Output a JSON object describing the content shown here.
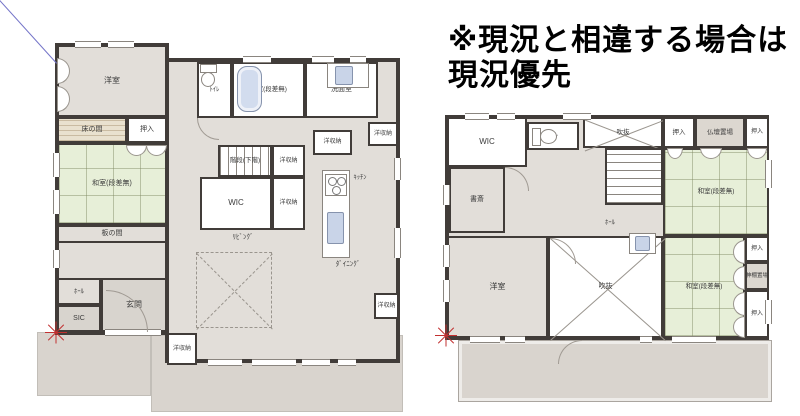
{
  "notice": {
    "line1": "※現況と相違する場合は",
    "line2": "現況優先"
  },
  "colors": {
    "wall": "#413c39",
    "floor": "#e2ded9",
    "tatami": "#e7efd8",
    "white": "#ffffff",
    "wood": "#e9e1cf",
    "ground": "#d9d4ce",
    "genkan": "#d8d4ce",
    "altar": "#dcd7d0",
    "fixture_blue": "#c9d4e8",
    "red_mark": "#c23030",
    "blue_line": "#7474c8"
  },
  "blue_line": {
    "x1": 0,
    "y1": 0,
    "x2": 57,
    "y2": 63
  },
  "floors": {
    "floor1": {
      "name": "first-floor-plan",
      "rooms": [
        {
          "id": "ground-left",
          "x": 37,
          "y": 332,
          "w": 114,
          "h": 64,
          "t": "ground"
        },
        {
          "id": "ground-main",
          "x": 151,
          "y": 335,
          "w": 252,
          "h": 77,
          "t": "ground"
        },
        {
          "id": "outline-west-wing",
          "x": 55,
          "y": 43,
          "w": 114,
          "h": 292,
          "t": "outline"
        },
        {
          "id": "outline-main",
          "x": 165,
          "y": 58,
          "w": 235,
          "h": 305,
          "t": "outline"
        },
        {
          "id": "room-yoshitsu-1f",
          "label": "洋室",
          "x": 57,
          "y": 45,
          "w": 110,
          "h": 72,
          "t": "floor",
          "fs": 8
        },
        {
          "id": "room-tokonoma",
          "label": "床の間",
          "x": 57,
          "y": 117,
          "w": 70,
          "h": 26,
          "t": "wood",
          "fs": 7
        },
        {
          "id": "room-oshiire-1f",
          "label": "押入",
          "x": 127,
          "y": 117,
          "w": 40,
          "h": 26,
          "t": "white",
          "fs": 7
        },
        {
          "id": "room-washitsu-1f",
          "label": "和室(段差無)",
          "x": 57,
          "y": 143,
          "w": 110,
          "h": 82,
          "t": "tatami",
          "fs": 7
        },
        {
          "id": "room-itanoma",
          "label": "板の間",
          "x": 57,
          "y": 225,
          "w": 110,
          "h": 18,
          "t": "floor",
          "fs": 7
        },
        {
          "id": "room-hall-1f",
          "label": "ﾎｰﾙ",
          "x": 57,
          "y": 278,
          "w": 44,
          "h": 27,
          "t": "floor",
          "fs": 6.5
        },
        {
          "id": "room-sic",
          "label": "SIC",
          "x": 57,
          "y": 305,
          "w": 44,
          "h": 27,
          "t": "genkan",
          "fs": 7
        },
        {
          "id": "room-genkan",
          "label": "玄関",
          "x": 101,
          "y": 278,
          "w": 66,
          "h": 54,
          "t": "genkan",
          "fs": 8
        },
        {
          "id": "room-yoshuno-entrance",
          "label": "洋収納",
          "x": 167,
          "y": 333,
          "w": 30,
          "h": 32,
          "t": "white",
          "fs": 6
        },
        {
          "id": "room-toilet-1f",
          "label": "ﾄｲﾚ",
          "x": 197,
          "y": 62,
          "w": 35,
          "h": 56,
          "t": "white",
          "fs": 6.5
        },
        {
          "id": "room-bath",
          "label": "浴室(段差無)",
          "x": 232,
          "y": 62,
          "w": 73,
          "h": 56,
          "t": "white",
          "fs": 6.5
        },
        {
          "id": "room-senmen",
          "label": "洗面室",
          "x": 305,
          "y": 62,
          "w": 73,
          "h": 56,
          "t": "white",
          "fs": 7
        },
        {
          "id": "room-stairs-1f",
          "label": "階段(下階)",
          "x": 218,
          "y": 145,
          "w": 54,
          "h": 32,
          "t": "stairs-v",
          "fs": 6.5
        },
        {
          "id": "room-wic-1f",
          "label": "WIC",
          "x": 200,
          "y": 177,
          "w": 72,
          "h": 53,
          "t": "white",
          "fs": 8
        },
        {
          "id": "room-yoshuno-a",
          "label": "洋収納",
          "x": 272,
          "y": 145,
          "w": 33,
          "h": 32,
          "t": "white",
          "fs": 6
        },
        {
          "id": "room-yoshuno-b",
          "label": "洋収納",
          "x": 272,
          "y": 177,
          "w": 33,
          "h": 53,
          "t": "white",
          "fs": 6
        },
        {
          "id": "room-yoshuno-c",
          "label": "洋収納",
          "x": 313,
          "y": 130,
          "w": 39,
          "h": 25,
          "t": "white",
          "fs": 6
        },
        {
          "id": "room-yoshuno-d",
          "label": "洋収納",
          "x": 368,
          "y": 122,
          "w": 30,
          "h": 24,
          "t": "white",
          "fs": 6
        },
        {
          "id": "room-yoshuno-e",
          "label": "洋収納",
          "x": 374,
          "y": 293,
          "w": 25,
          "h": 26,
          "t": "white",
          "fs": 6
        },
        {
          "id": "label-living",
          "label": "ﾘﾋﾞﾝｸﾞ",
          "x": 213,
          "y": 232,
          "w": 60,
          "h": 12,
          "t": "label",
          "fs": 7
        },
        {
          "id": "label-dining",
          "label": "ﾀﾞｲﾆﾝｸﾞ",
          "x": 318,
          "y": 259,
          "w": 60,
          "h": 12,
          "t": "label",
          "fs": 7
        },
        {
          "id": "label-kitchen",
          "label": "ｷｯﾁﾝ",
          "x": 342,
          "y": 172,
          "w": 36,
          "h": 11,
          "t": "label",
          "fs": 6.5
        },
        {
          "id": "living-void-outline",
          "x": 196,
          "y": 252,
          "w": 76,
          "h": 76,
          "t": "void-dashed"
        }
      ],
      "windows": [
        {
          "x": 75,
          "y": 41,
          "l": 26,
          "o": "h"
        },
        {
          "x": 108,
          "y": 41,
          "l": 26,
          "o": "h"
        },
        {
          "x": 243,
          "y": 56,
          "l": 28,
          "o": "h"
        },
        {
          "x": 312,
          "y": 56,
          "l": 22,
          "o": "h"
        },
        {
          "x": 350,
          "y": 56,
          "l": 16,
          "o": "h"
        },
        {
          "x": 208,
          "y": 359,
          "l": 34,
          "o": "h"
        },
        {
          "x": 252,
          "y": 359,
          "l": 44,
          "o": "h"
        },
        {
          "x": 302,
          "y": 359,
          "l": 28,
          "o": "h"
        },
        {
          "x": 338,
          "y": 359,
          "l": 18,
          "o": "h"
        },
        {
          "x": 105,
          "y": 329,
          "l": 56,
          "o": "h"
        },
        {
          "x": 394,
          "y": 158,
          "l": 22,
          "o": "v"
        },
        {
          "x": 394,
          "y": 228,
          "l": 30,
          "o": "v"
        },
        {
          "x": 53,
          "y": 153,
          "l": 24,
          "o": "v"
        },
        {
          "x": 53,
          "y": 190,
          "l": 24,
          "o": "v"
        },
        {
          "x": 53,
          "y": 250,
          "l": 18,
          "o": "v"
        }
      ],
      "fixtures": [
        {
          "k": "toilet",
          "x": 200,
          "y": 64,
          "w": 15,
          "h": 22,
          "dir": "d"
        },
        {
          "k": "tub",
          "x": 237,
          "y": 66,
          "w": 25,
          "h": 46
        },
        {
          "k": "counter",
          "x": 327,
          "y": 63,
          "w": 42,
          "h": 25
        },
        {
          "k": "sink",
          "x": 335,
          "y": 66,
          "w": 18,
          "h": 19
        },
        {
          "k": "counter",
          "x": 322,
          "y": 170,
          "w": 28,
          "h": 88
        },
        {
          "k": "stove",
          "x": 325,
          "y": 174,
          "w": 22,
          "h": 22
        },
        {
          "k": "sink",
          "x": 327,
          "y": 212,
          "w": 17,
          "h": 32
        },
        {
          "k": "half",
          "x": 57,
          "y": 58,
          "w": 13,
          "h": 26,
          "dir": "r"
        },
        {
          "k": "half",
          "x": 57,
          "y": 86,
          "w": 13,
          "h": 26,
          "dir": "r"
        },
        {
          "k": "half",
          "x": 126,
          "y": 145,
          "w": 21,
          "h": 11,
          "dir": "d"
        },
        {
          "k": "half",
          "x": 146,
          "y": 145,
          "w": 21,
          "h": 11,
          "dir": "d"
        }
      ],
      "arcs": [
        {
          "x": 106,
          "y": 290,
          "r": 42,
          "c": "tr"
        },
        {
          "x": 197,
          "y": 118,
          "r": 22,
          "c": "bl"
        }
      ],
      "marks": [
        {
          "x": 56,
          "y": 333
        }
      ]
    },
    "floor2": {
      "name": "second-floor-plan",
      "rooms": [
        {
          "id": "balcony",
          "x": 458,
          "y": 340,
          "w": 314,
          "h": 62,
          "t": "balcony"
        },
        {
          "id": "outline-2f",
          "x": 445,
          "y": 115,
          "w": 324,
          "h": 225,
          "t": "outline"
        },
        {
          "id": "room-wic-2f",
          "label": "WIC",
          "x": 447,
          "y": 117,
          "w": 80,
          "h": 50,
          "t": "white",
          "fs": 8
        },
        {
          "id": "room-toilet-2f",
          "label": "ﾄｲﾚ",
          "x": 527,
          "y": 122,
          "w": 52,
          "h": 28,
          "t": "white",
          "fs": 6.5
        },
        {
          "id": "room-shosai",
          "label": "書斎",
          "x": 449,
          "y": 167,
          "w": 56,
          "h": 66,
          "t": "floor",
          "fs": 7
        },
        {
          "id": "room-void-top",
          "label": "吹抜",
          "x": 583,
          "y": 117,
          "w": 80,
          "h": 31,
          "t": "void",
          "fs": 6.5
        },
        {
          "id": "room-stairs-2f",
          "x": 605,
          "y": 148,
          "w": 58,
          "h": 57,
          "t": "stairs-h"
        },
        {
          "id": "room-oshiire-2f-a",
          "label": "押入",
          "x": 663,
          "y": 117,
          "w": 32,
          "h": 31,
          "t": "white",
          "fs": 6.5
        },
        {
          "id": "room-butsudan",
          "label": "仏壇置場",
          "x": 695,
          "y": 117,
          "w": 50,
          "h": 31,
          "t": "altar",
          "fs": 6.5
        },
        {
          "id": "room-oshiire-2f-b",
          "label": "押入",
          "x": 745,
          "y": 117,
          "w": 24,
          "h": 31,
          "t": "white",
          "fs": 6
        },
        {
          "id": "room-washitsu-2f-upper",
          "label": "和室(段差無)",
          "x": 663,
          "y": 148,
          "w": 106,
          "h": 88,
          "t": "tatami",
          "fs": 6.5
        },
        {
          "id": "room-washitsu-2f-lower",
          "label": "和室(段差無)",
          "x": 663,
          "y": 236,
          "w": 82,
          "h": 102,
          "t": "tatami",
          "fs": 6.5
        },
        {
          "id": "room-oshiire-2f-c",
          "label": "押入",
          "x": 745,
          "y": 236,
          "w": 24,
          "h": 26,
          "t": "white",
          "fs": 6
        },
        {
          "id": "room-kamidana",
          "label": "神棚置場",
          "x": 745,
          "y": 262,
          "w": 24,
          "h": 28,
          "t": "altar",
          "fs": 5.5
        },
        {
          "id": "room-oshiire-2f-d",
          "label": "押入",
          "x": 745,
          "y": 290,
          "w": 24,
          "h": 48,
          "t": "white",
          "fs": 6
        },
        {
          "id": "room-yoshitsu-2f",
          "label": "洋室",
          "x": 447,
          "y": 236,
          "w": 101,
          "h": 102,
          "t": "floor",
          "fs": 8
        },
        {
          "id": "room-void-bottom",
          "label": "吹抜",
          "x": 548,
          "y": 236,
          "w": 115,
          "h": 102,
          "t": "void",
          "fs": 7
        },
        {
          "id": "label-hall-2f",
          "label": "ﾎｰﾙ",
          "x": 595,
          "y": 217,
          "w": 30,
          "h": 12,
          "t": "label",
          "fs": 6.5
        }
      ],
      "windows": [
        {
          "x": 465,
          "y": 113,
          "l": 24,
          "o": "h"
        },
        {
          "x": 497,
          "y": 113,
          "l": 18,
          "o": "h"
        },
        {
          "x": 563,
          "y": 113,
          "l": 28,
          "o": "h"
        },
        {
          "x": 443,
          "y": 185,
          "l": 20,
          "o": "v"
        },
        {
          "x": 443,
          "y": 245,
          "l": 22,
          "o": "v"
        },
        {
          "x": 443,
          "y": 280,
          "l": 22,
          "o": "v"
        },
        {
          "x": 765,
          "y": 160,
          "l": 28,
          "o": "v"
        },
        {
          "x": 765,
          "y": 300,
          "l": 24,
          "o": "v"
        },
        {
          "x": 470,
          "y": 336,
          "l": 30,
          "o": "h"
        },
        {
          "x": 505,
          "y": 336,
          "l": 20,
          "o": "h"
        },
        {
          "x": 640,
          "y": 336,
          "l": 12,
          "o": "h"
        },
        {
          "x": 672,
          "y": 336,
          "l": 44,
          "o": "h"
        }
      ],
      "fixtures": [
        {
          "k": "toilet",
          "x": 532,
          "y": 128,
          "w": 24,
          "h": 16,
          "dir": "r"
        },
        {
          "k": "counter",
          "x": 629,
          "y": 233,
          "w": 27,
          "h": 21
        },
        {
          "k": "sink",
          "x": 635,
          "y": 236,
          "w": 15,
          "h": 15
        },
        {
          "k": "half",
          "x": 667,
          "y": 148,
          "w": 16,
          "h": 11,
          "dir": "d"
        },
        {
          "k": "half",
          "x": 700,
          "y": 148,
          "w": 22,
          "h": 11,
          "dir": "d"
        },
        {
          "k": "half",
          "x": 747,
          "y": 148,
          "w": 20,
          "h": 11,
          "dir": "d"
        },
        {
          "k": "half",
          "x": 733,
          "y": 240,
          "w": 12,
          "h": 24,
          "dir": "l"
        },
        {
          "k": "half",
          "x": 733,
          "y": 266,
          "w": 12,
          "h": 24,
          "dir": "l"
        },
        {
          "k": "half",
          "x": 733,
          "y": 292,
          "w": 12,
          "h": 24,
          "dir": "l"
        },
        {
          "k": "half",
          "x": 733,
          "y": 316,
          "w": 12,
          "h": 22,
          "dir": "l"
        }
      ],
      "arcs": [
        {
          "x": 505,
          "y": 167,
          "r": 24,
          "c": "tr"
        },
        {
          "x": 550,
          "y": 238,
          "r": 26,
          "c": "tr"
        },
        {
          "x": 558,
          "y": 340,
          "r": 24,
          "c": "tl"
        }
      ],
      "marks": [
        {
          "x": 446,
          "y": 336
        }
      ]
    }
  }
}
